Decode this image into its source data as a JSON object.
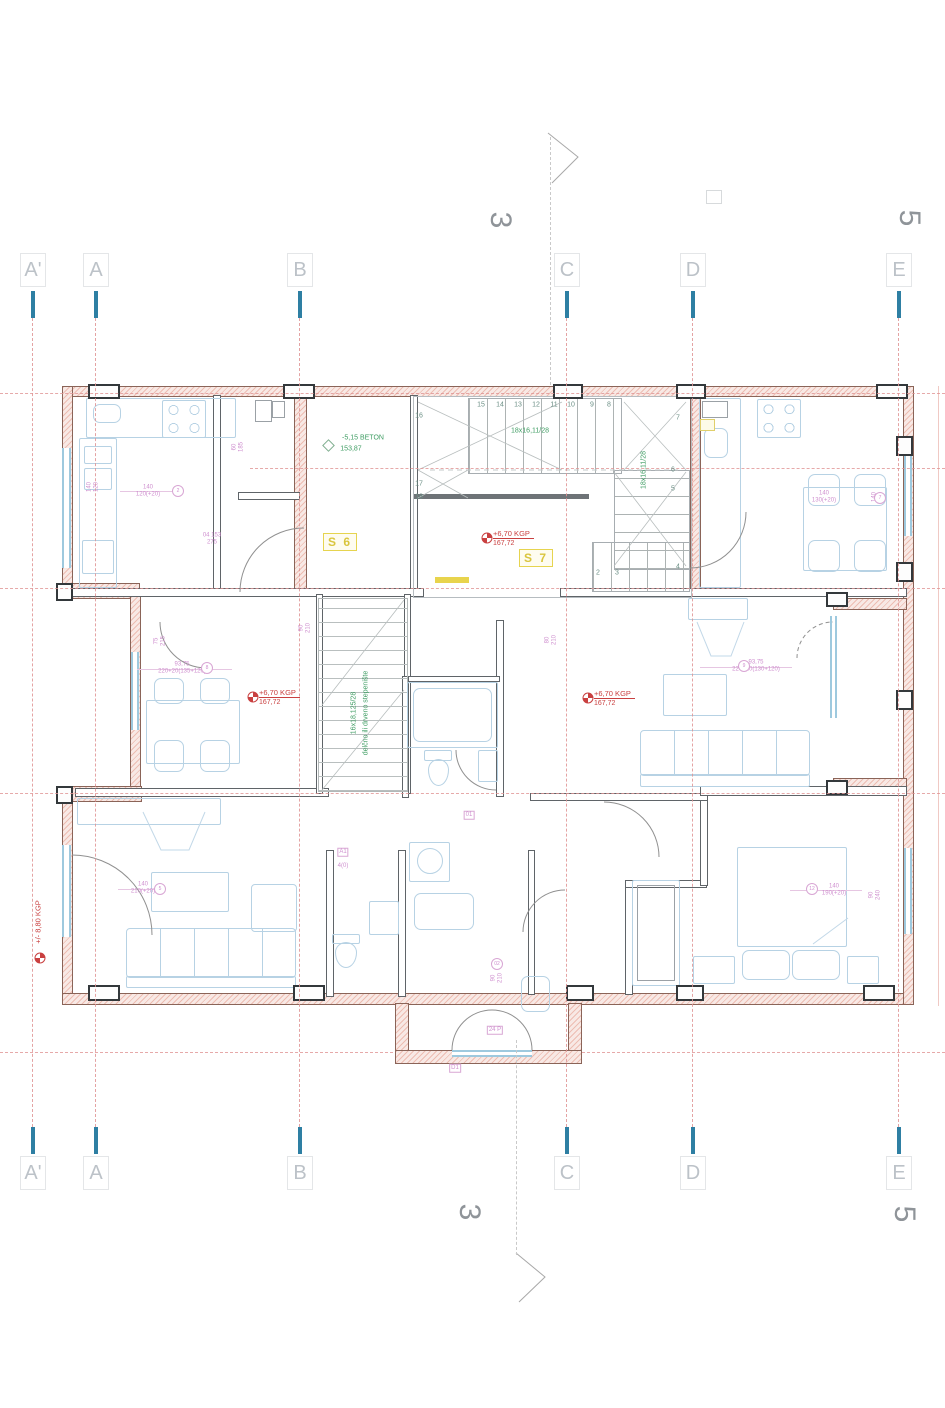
{
  "grid": {
    "columns": [
      {
        "t": "A'",
        "x": 33
      },
      {
        "t": "A",
        "x": 96
      },
      {
        "t": "B",
        "x": 300
      },
      {
        "t": "C",
        "x": 567
      },
      {
        "t": "D",
        "x": 693
      },
      {
        "t": "E",
        "x": 899
      }
    ],
    "section_markers": [
      {
        "t": "3",
        "x": 500,
        "y": 220
      },
      {
        "t": "5",
        "x": 909,
        "y": 218
      },
      {
        "t": "3",
        "x": 469,
        "y": 1212
      },
      {
        "t": "5",
        "x": 904,
        "y": 1214
      }
    ]
  },
  "plan": {
    "stair_numbers": [
      {
        "t": "15",
        "x": 481,
        "y": 405
      },
      {
        "t": "14",
        "x": 500,
        "y": 405
      },
      {
        "t": "13",
        "x": 518,
        "y": 405
      },
      {
        "t": "12",
        "x": 536,
        "y": 405
      },
      {
        "t": "11",
        "x": 554,
        "y": 405
      },
      {
        "t": "10",
        "x": 571,
        "y": 405
      },
      {
        "t": "9",
        "x": 592,
        "y": 405
      },
      {
        "t": "8",
        "x": 609,
        "y": 405
      },
      {
        "t": "16",
        "x": 419,
        "y": 416
      },
      {
        "t": "7",
        "x": 678,
        "y": 418
      },
      {
        "t": "17",
        "x": 419,
        "y": 484
      },
      {
        "t": "18",
        "x": 419,
        "y": 497
      },
      {
        "t": "6",
        "x": 673,
        "y": 470
      },
      {
        "t": "5",
        "x": 673,
        "y": 489
      },
      {
        "t": "4",
        "x": 678,
        "y": 567
      },
      {
        "t": "3",
        "x": 617,
        "y": 573
      },
      {
        "t": "2",
        "x": 598,
        "y": 573
      }
    ],
    "green_notes": [
      {
        "t": "-5,15 BETON",
        "x": 363,
        "y": 438
      },
      {
        "t": "153,87",
        "x": 351,
        "y": 449
      },
      {
        "t": "18x16,11/28",
        "x": 530,
        "y": 431
      },
      {
        "t": "18x16,11/28",
        "x": 644,
        "y": 470,
        "cls": "vrt"
      },
      {
        "t": "16x18,125/28",
        "x": 354,
        "y": 713,
        "cls": "vrt"
      },
      {
        "t": "delčno ili drveno stepenište",
        "x": 366,
        "y": 713,
        "cls": "vrt"
      }
    ],
    "red_markers": [
      {
        "l1": "+6,70 KGP",
        "l2": "167,72",
        "x": 487,
        "y": 538
      },
      {
        "l1": "+6,70 KGP",
        "l2": "167,72",
        "x": 253,
        "y": 697
      },
      {
        "l1": "+6,70 KGP",
        "l2": "167,72",
        "x": 588,
        "y": 698
      }
    ],
    "red_marker_vertical": {
      "t": "+/- 8,80 KGP"
    },
    "unit_labels": [
      {
        "t": "S 6",
        "x": 340,
        "y": 542
      },
      {
        "t": "S 7",
        "x": 536,
        "y": 558
      }
    ],
    "pink_notes": [
      {
        "t": "140\n120(+20)",
        "x": 148,
        "y": 491
      },
      {
        "t": "140\n120",
        "x": 93,
        "y": 487,
        "cls": "vrt"
      },
      {
        "t": "60\n185",
        "x": 238,
        "y": 447,
        "cls": "vrt"
      },
      {
        "t": "04 153\n275",
        "x": 212,
        "y": 539
      },
      {
        "t": "75\n215",
        "x": 160,
        "y": 641,
        "cls": "vrt"
      },
      {
        "t": "90\n210",
        "x": 305,
        "y": 628,
        "cls": "vrt"
      },
      {
        "t": "93,75\n220+20(135+120)",
        "x": 182,
        "y": 668
      },
      {
        "t": "93,75\n220+20(130+120)",
        "x": 756,
        "y": 666
      },
      {
        "t": "140\n130(+20)",
        "x": 824,
        "y": 497
      },
      {
        "t": "140\n120",
        "x": 878,
        "y": 497,
        "cls": "vrt"
      },
      {
        "t": "80\n210",
        "x": 551,
        "y": 640,
        "cls": "vrt"
      },
      {
        "t": "140\n210(+20)",
        "x": 143,
        "y": 888
      },
      {
        "t": "140\n190(+20)",
        "x": 834,
        "y": 890
      },
      {
        "t": "90\n240",
        "x": 875,
        "y": 895,
        "cls": "vrt"
      },
      {
        "t": "90\n210",
        "x": 497,
        "y": 978,
        "cls": "vrt"
      },
      {
        "t": "A1",
        "x": 343,
        "y": 852,
        "cls": "box"
      },
      {
        "t": "4(0)",
        "x": 343,
        "y": 866
      },
      {
        "t": "01",
        "x": 469,
        "y": 815,
        "cls": "box"
      },
      {
        "t": "24 P",
        "x": 495,
        "y": 1030,
        "cls": "box"
      },
      {
        "t": "D1",
        "x": 455,
        "y": 1068,
        "cls": "box"
      }
    ],
    "pink_circles": [
      {
        "t": "2",
        "x": 178,
        "y": 491
      },
      {
        "t": "8",
        "x": 207,
        "y": 668
      },
      {
        "t": "9",
        "x": 744,
        "y": 666
      },
      {
        "t": "12",
        "x": 812,
        "y": 889
      },
      {
        "t": "5",
        "x": 160,
        "y": 889
      },
      {
        "t": "7",
        "x": 880,
        "y": 498
      },
      {
        "t": "02",
        "x": 497,
        "y": 964
      }
    ]
  }
}
